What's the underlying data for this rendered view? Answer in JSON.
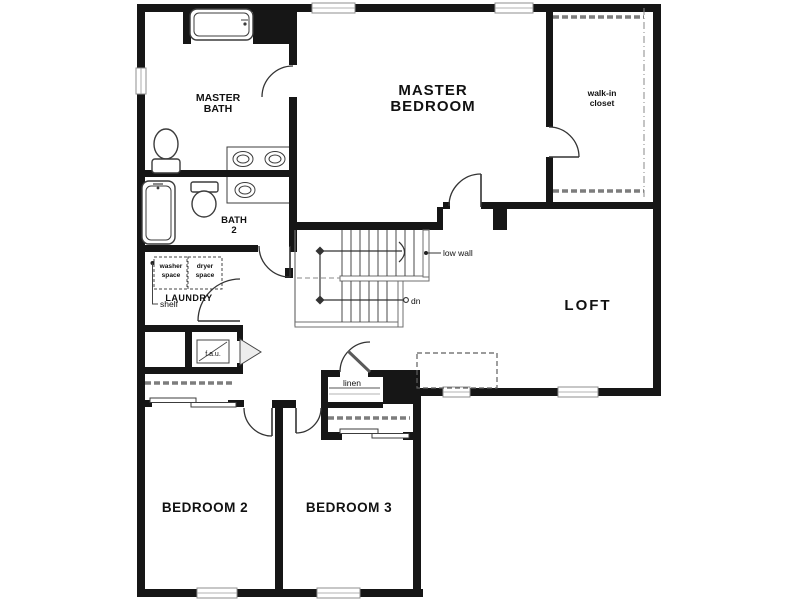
{
  "colors": {
    "wall": "#161616",
    "fixture": "#3c3c3c",
    "stair": "#6f6f6f",
    "text": "#111111",
    "bg": "#ffffff",
    "dash": "#7d7d7d",
    "door": "#333333"
  },
  "rooms": {
    "master_bath": {
      "lines": [
        "MASTER",
        "BATH"
      ]
    },
    "master_bedroom": {
      "lines": [
        "MASTER",
        "BEDROOM"
      ]
    },
    "walk_in_closet": {
      "lines": [
        "walk-in",
        "closet"
      ]
    },
    "bath_2": {
      "lines": [
        "BATH",
        "2"
      ]
    },
    "laundry": {
      "label": "LAUNDRY"
    },
    "loft": {
      "label": "LOFT"
    },
    "bedroom_2": {
      "label": "BEDROOM 2"
    },
    "bedroom_3": {
      "label": "BEDROOM 3"
    },
    "linen": {
      "label": "linen"
    }
  },
  "annotations": {
    "washer_space": {
      "lines": [
        "washer",
        "space"
      ]
    },
    "dryer_space": {
      "lines": [
        "dryer",
        "space"
      ]
    },
    "shelf": "shelf",
    "fau": "f.a.u.",
    "low_wall": "low wall",
    "down": "dn"
  },
  "fixtures": [
    "bathtub",
    "toilet",
    "double-vanity-sinks",
    "bathtub",
    "toilet",
    "vanity-sink",
    "washer-space",
    "dryer-space",
    "stairs-down",
    "linen-shelves",
    "closet-rod-shelf"
  ]
}
